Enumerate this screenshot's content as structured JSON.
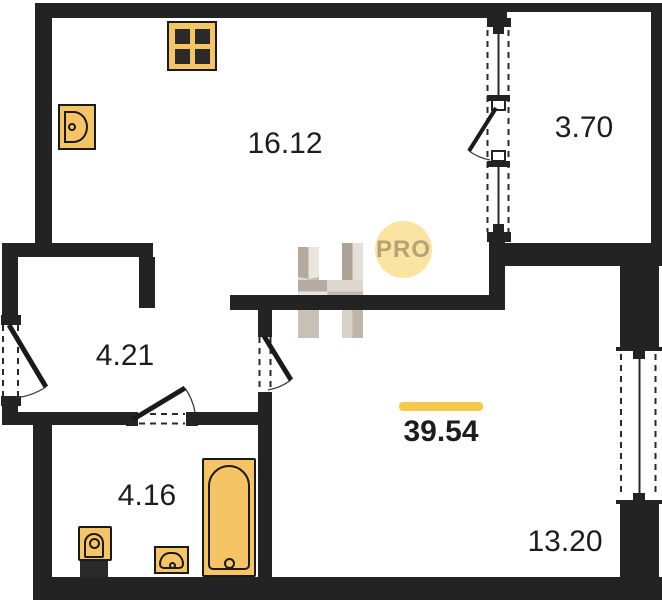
{
  "rooms": [
    {
      "area": "16.12"
    },
    {
      "area": "3.70"
    },
    {
      "area": "4.21"
    },
    {
      "area": "4.16"
    },
    {
      "area": "13.20"
    }
  ],
  "total_area": "39.54",
  "badge": "PRO",
  "fixtures": [
    "stove-icon",
    "kitchen-sink-icon",
    "toilet-icon",
    "washbasin-icon",
    "bathtub-icon"
  ],
  "features": [
    "entrance-door",
    "bathroom-door",
    "room-door",
    "balcony-door",
    "balcony-window",
    "room-window"
  ],
  "colors": {
    "wall": "#232323",
    "fixture_fill": "#F5C464",
    "accent_bar": "#F6C84B",
    "badge_bg": "#FBE3A2",
    "badge_text": "#B3A377",
    "label_text": "#1d1d1d"
  }
}
